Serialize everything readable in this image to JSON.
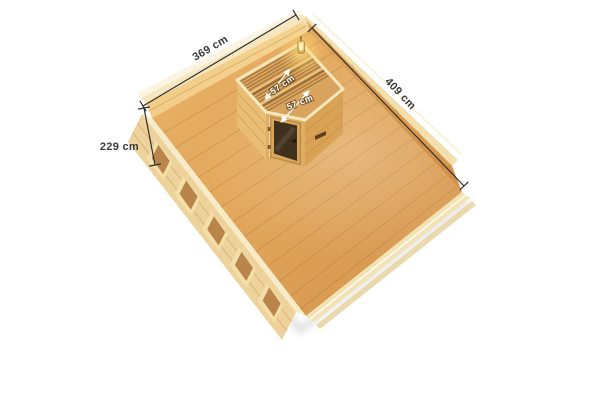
{
  "scene": {
    "description": "Isometric cutaway view of a wooden garden house with built-in corner sauna, annotated with dimensions",
    "unit": "cm",
    "background_color": "#ffffff"
  },
  "dimension_labels": {
    "house_width": "369 cm",
    "house_depth": "409 cm",
    "wall_height": "229 cm",
    "sauna_bench_upper": "57 cm",
    "sauna_bench_lower": "57 cm"
  },
  "colors": {
    "dimension_line": "#2f2f2f",
    "dimension_text": "#3a3a3a",
    "bench_dimension_text": "#ffffff",
    "floor_wood_light": "#eebb75",
    "floor_wood_dark": "#d2914a",
    "back_wall_interior": "#f3cd8b",
    "right_wall_interior": "#dd9e53",
    "exterior_wall": "#eed29b",
    "wall_top_beam": "#f7ecc8",
    "sauna_wall": "#e6b76e",
    "sauna_door_glass": "#40301e",
    "bench_wood": "#d9a55e",
    "lamp_glow": "#ffd977"
  }
}
